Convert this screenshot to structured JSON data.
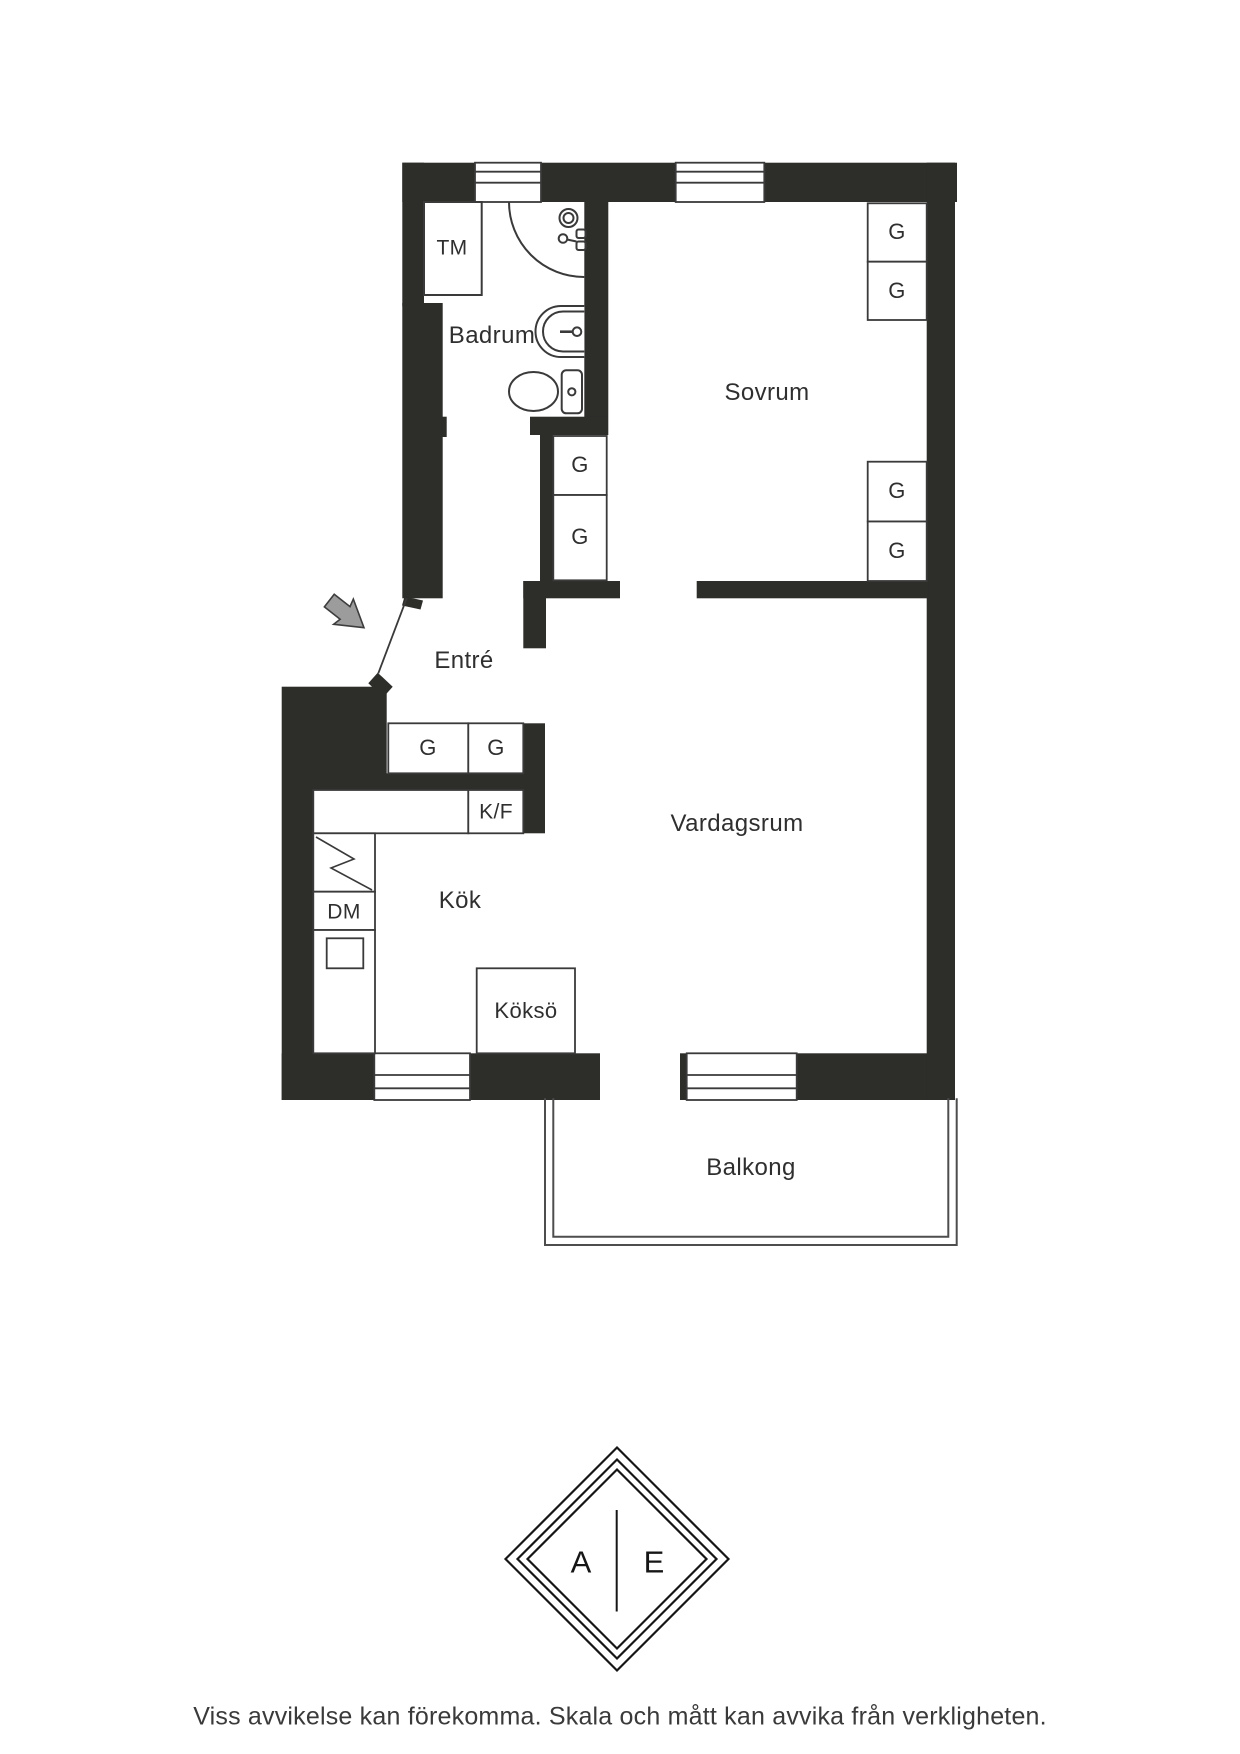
{
  "floorplan": {
    "room_labels": {
      "badrum": "Badrum",
      "sovrum": "Sovrum",
      "entre": "Entré",
      "kok": "Kök",
      "vardagsrum": "Vardagsrum",
      "balkong": "Balkong"
    },
    "fixture_labels": {
      "washing_machine": "TM",
      "dishwasher": "DM",
      "fridge_freezer": "K/F",
      "kitchen_island": "Köksö",
      "wardrobe": "G"
    }
  },
  "logo": {
    "left_letter": "A",
    "right_letter": "E"
  },
  "footer": {
    "disclaimer": "Viss avvikelse kan förekomma. Skala och mått kan avvika från verkligheten."
  },
  "colors": {
    "wall": "#2d2d2a",
    "line": "#3a3a3a",
    "balcony_line": "#4d4d4d",
    "text": "#2f2f2f",
    "arrow_fill": "#9c9c9c",
    "arrow_stroke": "#3d3d3d",
    "background": "#ffffff"
  }
}
